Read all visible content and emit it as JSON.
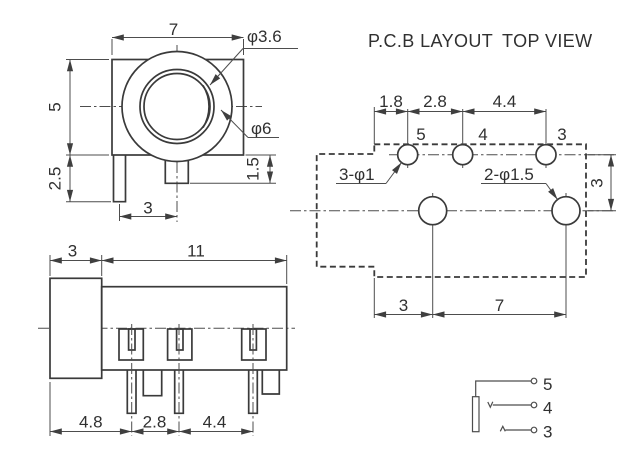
{
  "colors": {
    "line": "#3a3a3a",
    "thin_line": "#4d4d4d",
    "text": "#303030",
    "background": "#ffffff"
  },
  "front_view": {
    "dim_width": "7",
    "dim_inner_dia": "φ3.6",
    "dim_outer_dia": "φ6",
    "dim_height": "5",
    "dim_pin_length": "2.5",
    "dim_tab_height": "1.5",
    "dim_pin_offset": "3"
  },
  "side_view": {
    "dim_sleeve_width": "3",
    "dim_body_width": "11",
    "dim_pitch_a": "4.8",
    "dim_pitch_b": "2.8",
    "dim_pitch_c": "4.4"
  },
  "pcb_layout": {
    "title_left": "P.C.B LAYOUT",
    "title_right": "TOP VIEW",
    "dim_a": "1.8",
    "dim_b": "2.8",
    "dim_c": "4.4",
    "pad5": "5",
    "pad4": "4",
    "pad3": "3",
    "small_holes_label": "3-φ1",
    "large_holes_label": "2-φ1.5",
    "dim_row_spacing": "3",
    "dim_bottom_a": "3",
    "dim_bottom_b": "7"
  },
  "schematic": {
    "pin5": "5",
    "pin4": "4",
    "pin3": "3"
  }
}
